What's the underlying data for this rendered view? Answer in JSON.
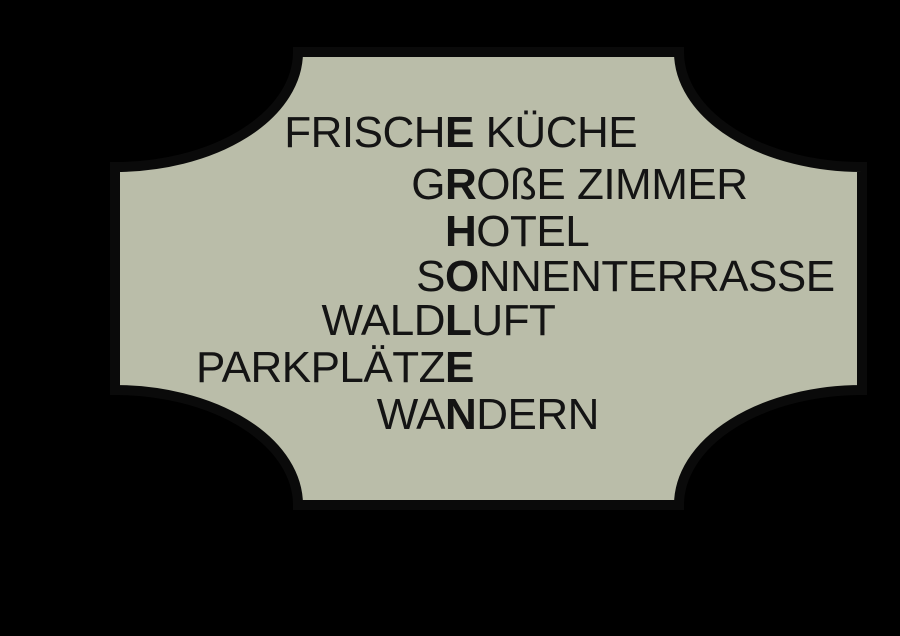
{
  "sign": {
    "vertical_word": "ERHOLEN",
    "lines": [
      {
        "pre": "FRISCH",
        "key": "E",
        "post": " KÜCHE"
      },
      {
        "pre": "G",
        "key": "R",
        "post": "OßE ZIMMER"
      },
      {
        "pre": "",
        "key": "H",
        "post": "OTEL"
      },
      {
        "pre": "S",
        "key": "O",
        "post": "NNENTERRASSE"
      },
      {
        "pre": "WALD",
        "key": "L",
        "post": "UFT"
      },
      {
        "pre": "PARKPLÄTZ",
        "key": "E",
        "post": ""
      },
      {
        "pre": "WA",
        "key": "N",
        "post": "DERN"
      }
    ]
  },
  "colors": {
    "background": "#000000",
    "plaque": "#babda9",
    "outline": "#0a0a0a",
    "text": "#141414"
  }
}
